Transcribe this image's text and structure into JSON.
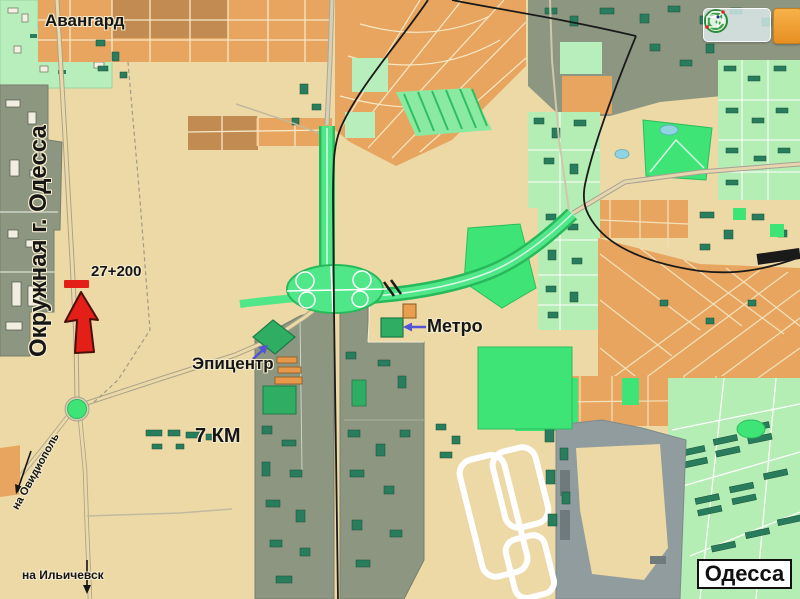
{
  "map": {
    "region_labels": {
      "avangard": "Авангард",
      "ring_road": "Окружная г. Одесса",
      "city": "Одесса"
    },
    "markers": {
      "km_post": "27+200",
      "epicentr": "Эпицентр",
      "metro": "Метро",
      "km7_market": "7 КМ"
    },
    "directions": {
      "ovidiopol": "на Овидиополь",
      "ilyichevsk": "на Ильичевск"
    },
    "toolbar": {
      "icons": [
        "ruler-icon",
        "compass-icon",
        "cube-3d-icon"
      ]
    },
    "colors": {
      "land": "#ecd9a6",
      "blocks_orange": "#e8a55f",
      "blocks_brown": "#c28b52",
      "residential_green": "#b5eeb5",
      "industrial_olive": "#8d9680",
      "park_green": "#3fe476",
      "highway_green": "#4fe788",
      "building_teal": "#2a7d5c",
      "water_blue": "#8fd4e0",
      "concrete_grey": "#919c9e",
      "marker_red": "#e41f18",
      "pointer_purple": "#5353d6",
      "railway_black": "#1a1a1a"
    }
  }
}
